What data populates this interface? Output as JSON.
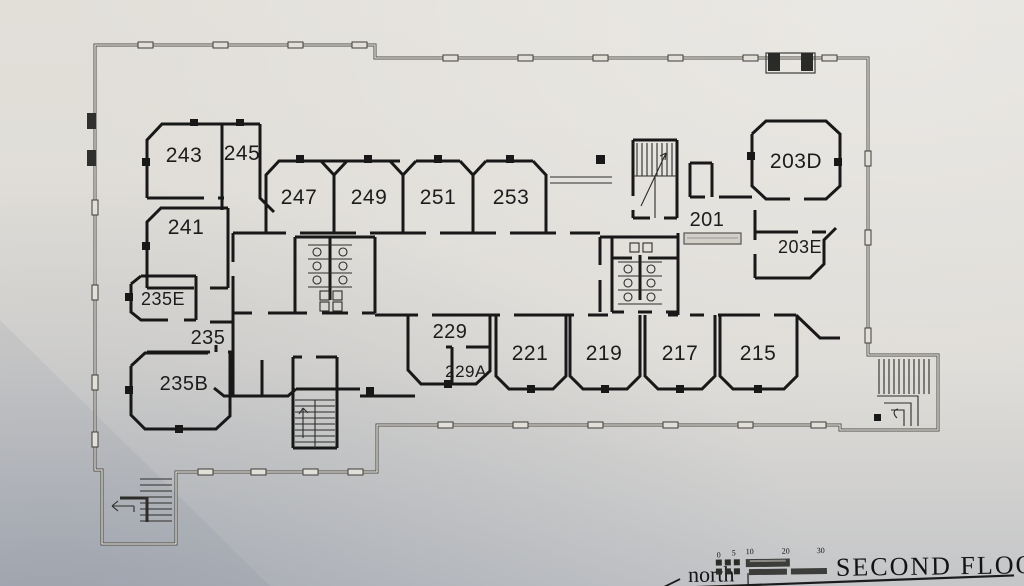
{
  "plan": {
    "title": "SECOND FLOOR",
    "compass_label": "north",
    "scale_ticks": [
      "0",
      "5",
      "10",
      "20",
      "30"
    ],
    "rooms": {
      "r243": "243",
      "r245": "245",
      "r247": "247",
      "r249": "249",
      "r251": "251",
      "r253": "253",
      "r241": "241",
      "r235e": "235E",
      "r235": "235",
      "r235b": "235B",
      "r229": "229",
      "r229a": "229A",
      "r221": "221",
      "r219": "219",
      "r217": "217",
      "r215": "215",
      "r201": "201",
      "r203d": "203D",
      "r203e": "203E"
    },
    "colors": {
      "paper": "#e2dfd9",
      "ink": "#1b1b1b",
      "outline": "#4b4a44",
      "shadow_tint": "#8d97a8"
    }
  }
}
